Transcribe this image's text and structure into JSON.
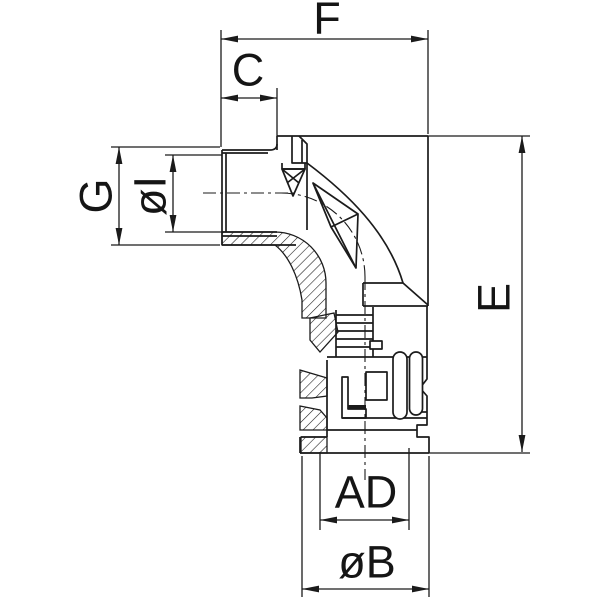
{
  "drawing": {
    "title": "Dimensioned sectional drawing of a 90-degree elbow conduit fitting",
    "view": "side section",
    "background_color": "#ffffff",
    "line_color": "#1b1b1b",
    "dimensions": {
      "F": {
        "label": "F",
        "orientation": "horizontal",
        "measures": "overall width across top"
      },
      "C": {
        "label": "C",
        "orientation": "horizontal",
        "measures": "thread length"
      },
      "G": {
        "label": "G",
        "orientation": "vertical",
        "measures": "thread outer height"
      },
      "oI": {
        "label": "øI",
        "orientation": "vertical",
        "measures": "inner diameter of inlet"
      },
      "E": {
        "label": "E",
        "orientation": "vertical",
        "measures": "overall height"
      },
      "AD": {
        "label": "AD",
        "orientation": "horizontal",
        "measures": "conduit entry diameter"
      },
      "oB": {
        "label": "øB",
        "orientation": "horizontal",
        "measures": "flange outer diameter"
      }
    }
  }
}
